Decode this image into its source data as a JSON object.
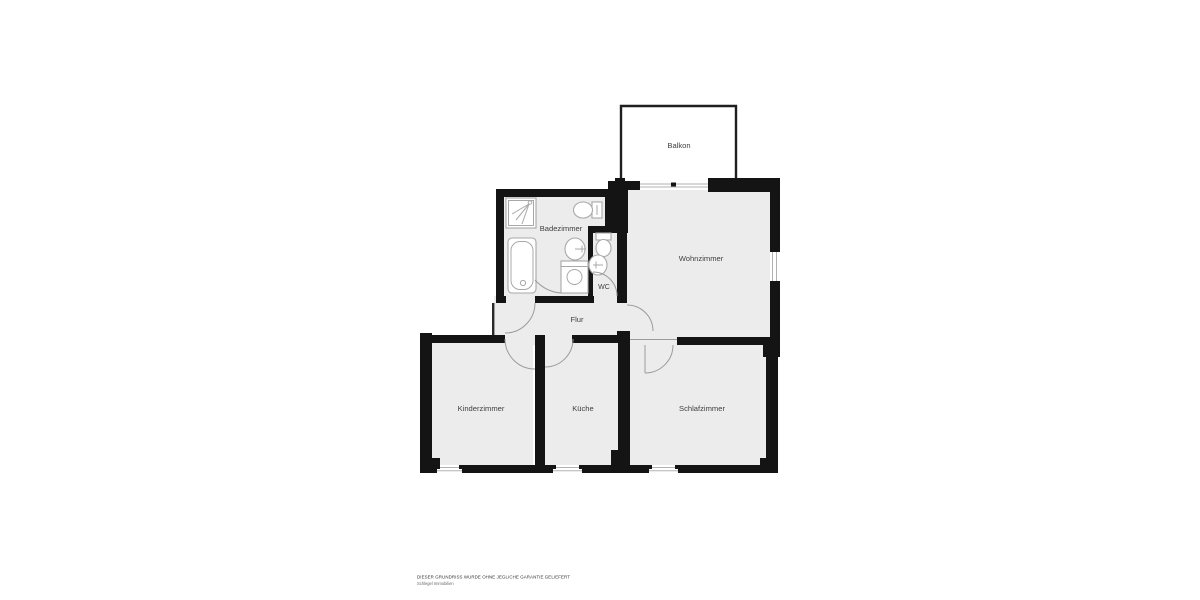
{
  "plan": {
    "rooms": [
      {
        "id": "balkon",
        "label": "Balkon"
      },
      {
        "id": "badezimmer",
        "label": "Badezimmer"
      },
      {
        "id": "wc",
        "label": "WC"
      },
      {
        "id": "wohnzimmer",
        "label": "Wohnzimmer"
      },
      {
        "id": "flur",
        "label": "Flur"
      },
      {
        "id": "kinderzimmer",
        "label": "Kinderzimmer"
      },
      {
        "id": "kueche",
        "label": "Küche"
      },
      {
        "id": "schlafzimmer",
        "label": "Schlafzimmer"
      }
    ],
    "watermark": {
      "line1": "DIESER GRUNDRISS WURDE OHNE JEGLICHE GARANTIE GELIEFERT",
      "line2": "Schlegel Immobilien"
    },
    "colors": {
      "wall": "#141414",
      "room_fill": "#ececec",
      "fixture_stroke": "#a8a8a8",
      "door_arc": "#9b9b9b",
      "window_line": "#b2b2b2",
      "label_color": "#3f3f3f",
      "balcony_stroke": "#1f1f1f",
      "watermark": "#333333"
    }
  }
}
